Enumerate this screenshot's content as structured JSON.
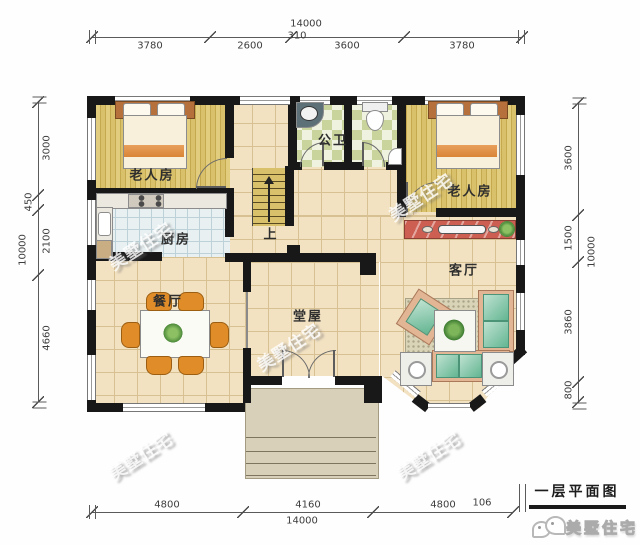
{
  "title": {
    "text": "一层平面图"
  },
  "brand": {
    "name": "美墅住宅"
  },
  "watermark": {
    "text": "美墅住宅"
  },
  "rooms": {
    "bedroom_left": "老人房",
    "bedroom_right": "老人房",
    "bathroom": "公卫",
    "kitchen": "厨房",
    "dining": "餐厅",
    "living": "客厅",
    "hall": "堂屋",
    "stairs_up": "上"
  },
  "dimensions": {
    "top": {
      "total": "14000",
      "offset": "310",
      "segments": [
        "3780",
        "2600",
        "3600",
        "3780"
      ]
    },
    "bottom": {
      "total": "14000",
      "offset": "106",
      "segments": [
        "4800",
        "4160",
        "4800"
      ]
    },
    "left": {
      "total": "10000",
      "segments": [
        "3000",
        "450",
        "2100",
        "4660"
      ]
    },
    "right": {
      "total": "10000",
      "segments": [
        "3600",
        "1500",
        "3860",
        "800"
      ]
    }
  },
  "colors": {
    "wall": "#181818",
    "floor_tile": "#f3e2c2",
    "floor_wood": "#d9c06a",
    "bath_tile": "#c9d49c",
    "kitchen_tile": "#e8f0f2",
    "tv_cabinet": "#cd5f52",
    "sofa": "#8fc9aa",
    "chair": "#e08c28",
    "porch": "#d9d0ba"
  }
}
